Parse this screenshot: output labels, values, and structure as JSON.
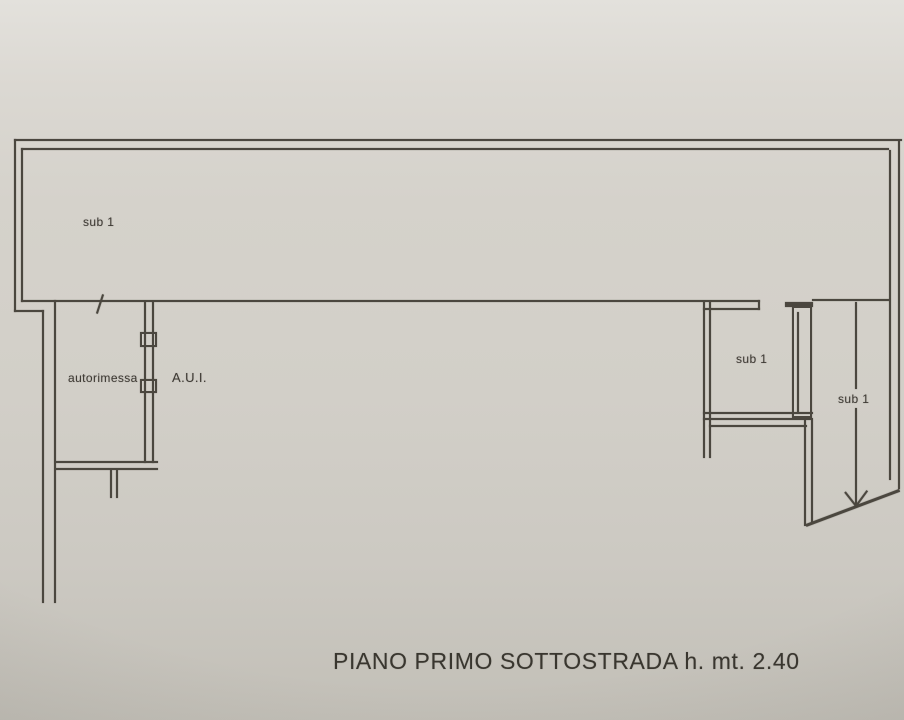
{
  "plan": {
    "rooms": {
      "main_hall_label": "sub 1",
      "garage_label": "autorimessa",
      "aui_label": "A.U.I.",
      "small_room_label": "sub 1",
      "ramp_area_label": "sub 1"
    },
    "caption": "PIANO PRIMO SOTTOSTRADA h. mt. 2.40",
    "icons": [
      "down-arrow-icon",
      "door-swing-tick-icon"
    ]
  },
  "colors": {
    "wall_line": "#4b473f",
    "paper_background": "#d2cfc8",
    "text": "#3e3a34"
  }
}
